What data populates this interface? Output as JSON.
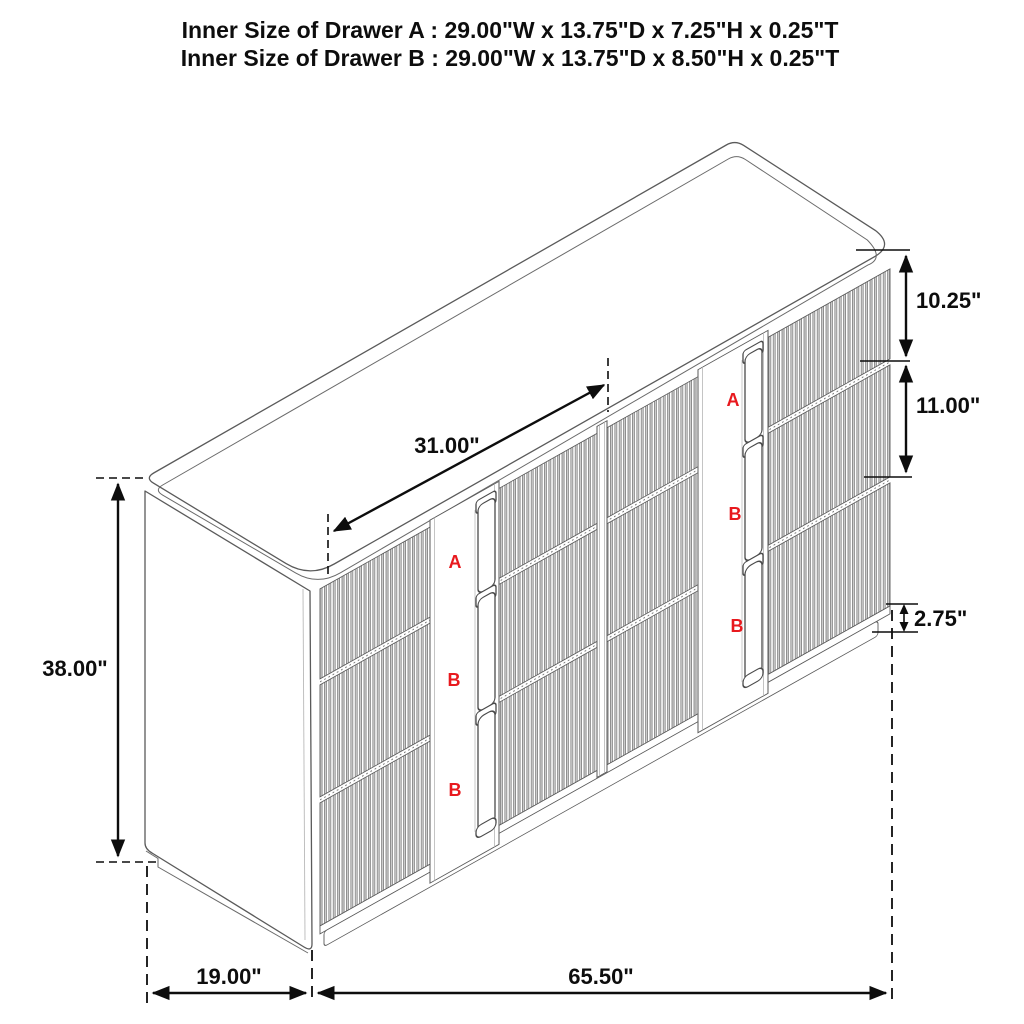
{
  "title": {
    "line1": "Inner Size of Drawer A : 29.00\"W x 13.75\"D x 7.25\"H x 0.25\"T",
    "line2": "Inner Size of Drawer B : 29.00\"W x 13.75\"D x 8.50\"H x 0.25\"T"
  },
  "dimensions": {
    "overall_height": "38.00\"",
    "drawer_opening_width": "31.00\"",
    "top_drawer_height": "10.25\"",
    "middle_drawer_height": "11.00\"",
    "base_height": "2.75\"",
    "depth": "19.00\"",
    "overall_width": "65.50\""
  },
  "drawer_labels": {
    "left": [
      "A",
      "B",
      "B"
    ],
    "right": [
      "A",
      "B",
      "B"
    ]
  },
  "colors": {
    "label_red": "#e8191e",
    "drawing_line": "#5a5a5a",
    "dimension_line": "#0d0d0d"
  }
}
